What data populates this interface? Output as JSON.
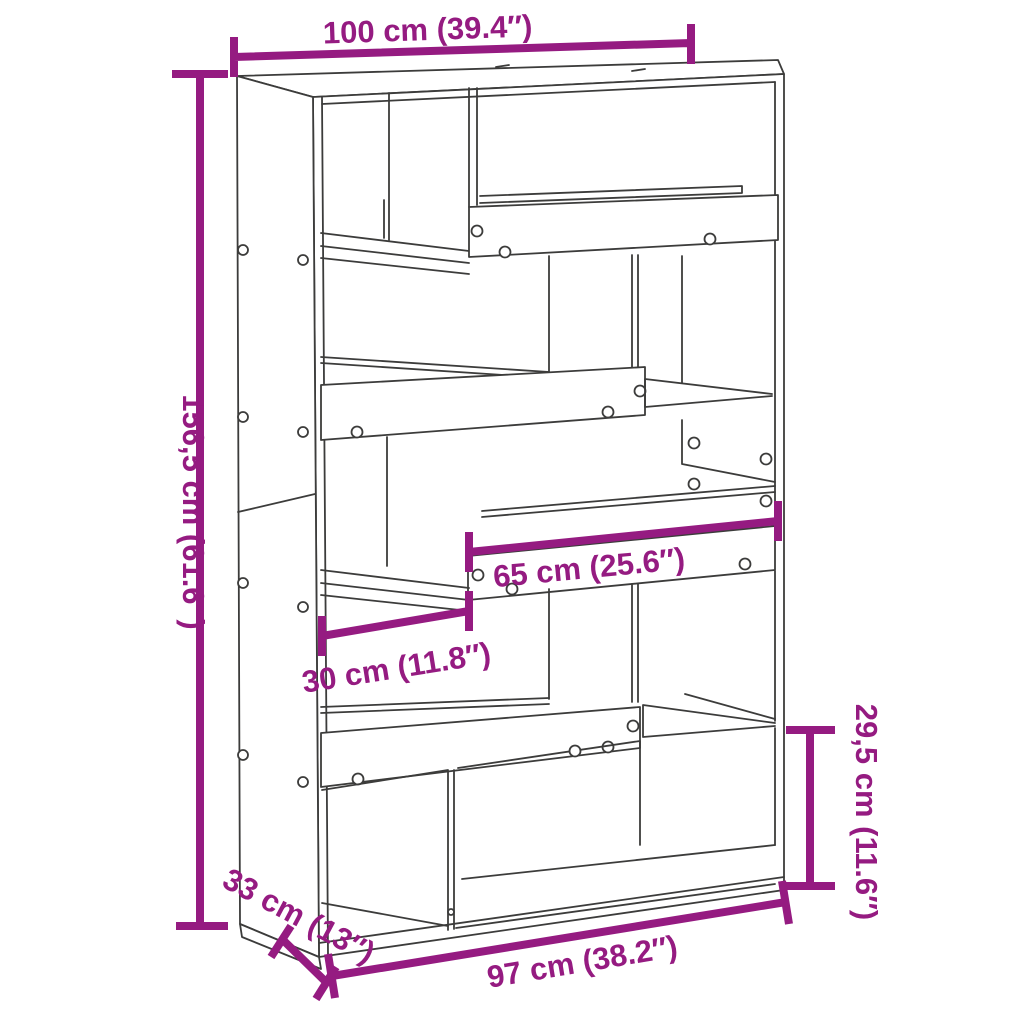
{
  "diagram": {
    "description": "Bookcase room divider dimension line drawing",
    "style": {
      "dimension_color": "#951b81",
      "line_color": "#3c3c3b",
      "background": "#ffffff"
    },
    "annotations": {
      "top_width": {
        "label": "100 cm (39.4″)"
      },
      "left_height": {
        "label": "156,5 cm (61.6″)"
      },
      "middle_shelf_width": {
        "label": "65 cm (25.6″)"
      },
      "small_shelf_width": {
        "label": "30 cm (11.8″)"
      },
      "right_shelf_height": {
        "label": "29,5 cm (11.6″)"
      },
      "depth": {
        "label": "33 cm (13″)"
      },
      "bottom_width": {
        "label": "97 cm (38.2″)"
      }
    }
  }
}
